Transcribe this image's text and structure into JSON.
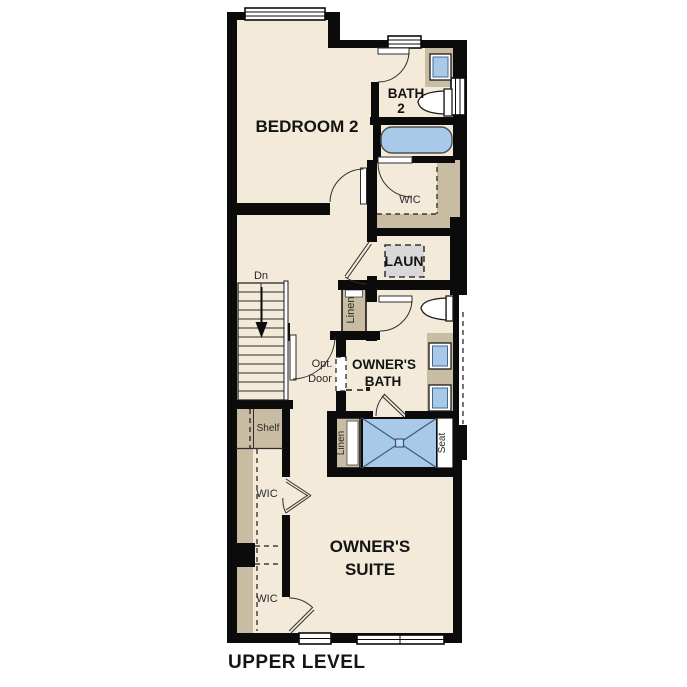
{
  "title": "UPPER LEVEL",
  "palette": {
    "wall": "#0b0b0b",
    "floor": "#f3ead9",
    "closet_tan": "#c8bca3",
    "fixture_blue": "#a9c9e9",
    "appliance_gray": "#d8d8d8",
    "background": "#ffffff"
  },
  "labels": {
    "bedroom2": "BEDROOM 2",
    "bath2_line1": "BATH",
    "bath2_line2": "2",
    "wic_bath": "WIC",
    "laundry": "LAUN",
    "linen_upper": "Linen",
    "down": "Dn",
    "opt_door_line1": "Opt.",
    "opt_door_line2": "Door",
    "owners_bath_line1": "OWNER'S",
    "owners_bath_line2": "BATH",
    "linen_lower": "Linen",
    "seat": "Seat",
    "shelf": "Shelf",
    "wic_upper": "WIC",
    "wic_lower": "WIC",
    "owners_suite_line1": "OWNER'S",
    "owners_suite_line2": "SUITE"
  }
}
